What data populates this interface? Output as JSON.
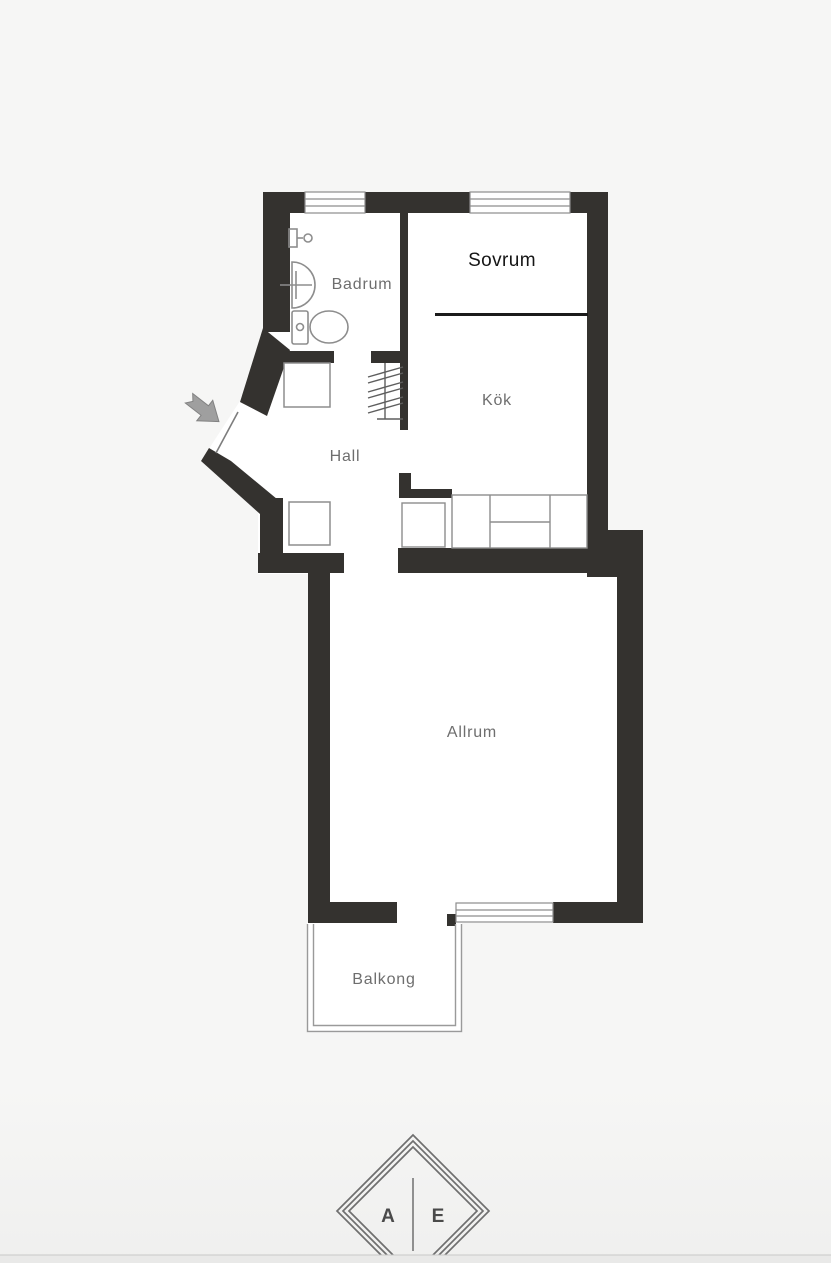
{
  "plan": {
    "rooms": {
      "sovrum": {
        "label": "Sovrum"
      },
      "badrum": {
        "label": "Badrum"
      },
      "kok": {
        "label": "Kök"
      },
      "hall": {
        "label": "Hall"
      },
      "allrum": {
        "label": "Allrum"
      },
      "balkong": {
        "label": "Balkong"
      }
    },
    "colors": {
      "wall": "#34322f",
      "room_fill": "#ffffff",
      "background": "#f6f6f5",
      "fixture_line": "#8d8d8d",
      "room_label": "#6e6e6e",
      "sovrum_label": "#151515",
      "entrance_arrow": "#9f9f9f"
    }
  },
  "logo": {
    "left_letter": "A",
    "right_letter": "E",
    "line_color": "#6f6f6f",
    "letter_color": "#4a4a4a"
  },
  "footer_bar": {
    "color": "#e9e9e8"
  }
}
